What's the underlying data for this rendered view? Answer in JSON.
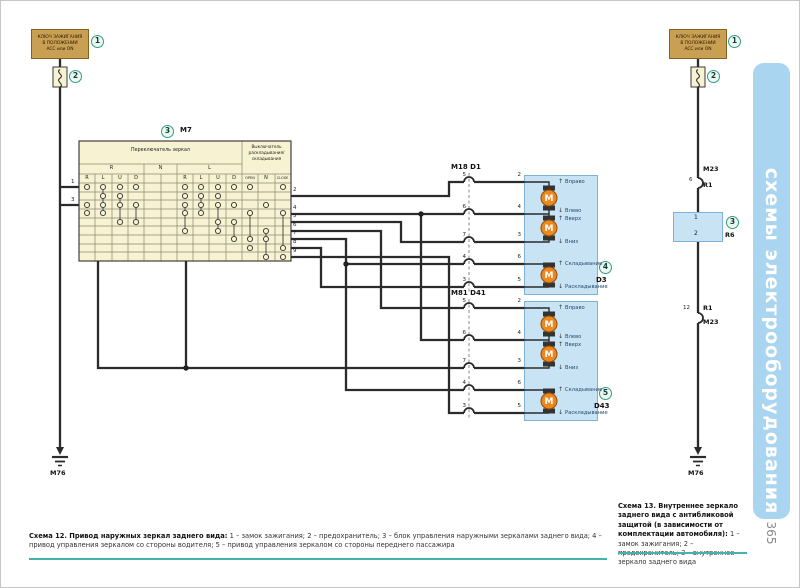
{
  "icons": {
    "up": "↑",
    "down": "↓"
  },
  "page": {
    "sidebar": "схемы электрооборудования",
    "number": "365"
  },
  "s12": {
    "ignition": "КЛЮЧ ЗАЖИГАНИЯ\nВ ПОЛОЖЕНИИ\nACC или ON",
    "callout_1": "1",
    "callout_2": "2",
    "callout_3": "3",
    "callout_4": "4",
    "callout_5": "5",
    "m7": {
      "ref": "M7",
      "header_left": "Переключатель зеркал",
      "header_right": "Выключатель\nраскладывания/\nскладывания",
      "group_r": "R",
      "group_n": "N",
      "group_l": "L",
      "cols": [
        "R",
        "L",
        "U",
        "D",
        "R",
        "L",
        "U",
        "D",
        "OPEN",
        "N",
        "CLOSE"
      ],
      "pin_left_1": "1",
      "pin_left_3": "3",
      "pins_right": [
        "2",
        "4",
        "5",
        "6",
        "7",
        "8",
        "9"
      ]
    },
    "block1": {
      "connector": "M18 D1",
      "conn_pins": [
        "5",
        "6",
        "7",
        "4",
        "3"
      ],
      "box_pins": [
        "2",
        "4",
        "3",
        "6",
        "5"
      ],
      "labels": [
        "Вправо",
        "Влево",
        "Вверх",
        "Вниз",
        "Складывание",
        "Раскладывание"
      ],
      "ref": "D3"
    },
    "block2": {
      "connector": "M81 D41",
      "conn_pins": [
        "5",
        "6",
        "7",
        "4",
        "3"
      ],
      "box_pins": [
        "2",
        "4",
        "3",
        "6",
        "5"
      ],
      "labels": [
        "Вправо",
        "Влево",
        "Вверх",
        "Вниз",
        "Складывание",
        "Раскладывание"
      ],
      "ref": "D43"
    },
    "ground": "М76",
    "caption_title": "Схема 12. Привод наружных зеркал заднего вида:",
    "caption_text": "1 – замок зажигания; 2 – предохранитель; 3 – блок управления наружными зеркалами заднего вида; 4 – привод управления зеркалом со стороны водителя; 5 – привод управления зеркалом со стороны переднего пассажира"
  },
  "s13": {
    "ignition": "КЛЮЧ ЗАЖИГАНИЯ\nВ ПОЛОЖЕНИИ\nACC или ON",
    "callout_1": "1",
    "callout_2": "2",
    "callout_3": "3",
    "conn_top_harness": "M23",
    "conn_top_pin": "6",
    "conn_top_unit": "R1",
    "r6_pin1": "1",
    "r6_pin2": "2",
    "r6_ref": "R6",
    "conn_bot_pin": "12",
    "conn_bot_unit": "R1",
    "conn_bot_harness": "M23",
    "ground": "М76",
    "caption_title": "Схема 13. Внутреннее зеркало заднего вида с антибликовой защитой (в зависимости от комплектации автомобиля):",
    "caption_text": "1 – замок зажигания; 2 – предохранитель; 3 – внутреннее зеркало заднего вида"
  }
}
